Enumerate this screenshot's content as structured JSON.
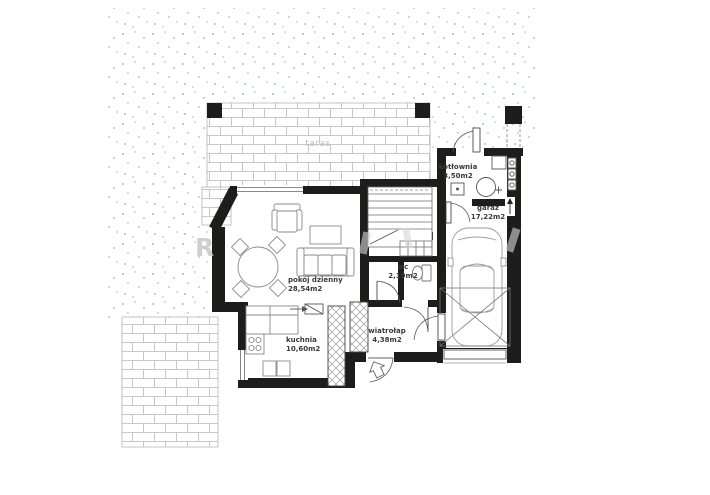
{
  "plan": {
    "rooms": [
      {
        "id": "pokoj-dzienny",
        "label": "pokój dzienny",
        "area": "28,54m2"
      },
      {
        "id": "kuchnia",
        "label": "kuchnia",
        "area": "10,60m2"
      },
      {
        "id": "wc",
        "label": "wc",
        "area": "2,19m2"
      },
      {
        "id": "wiatrolap",
        "label": "wiatrołap",
        "area": "4,38m2"
      },
      {
        "id": "kotlownia",
        "label": "kotłownia",
        "area": "3,50m2"
      },
      {
        "id": "garaz",
        "label": "garaż",
        "area": "17,22m2"
      }
    ],
    "outdoor_labels": {
      "terrace": "taras"
    },
    "watermark_letter": "R",
    "colors": {
      "wall": "#1d1d1b",
      "brick_line": "#c8c8c8",
      "ground_dots": "#7fa39e",
      "furniture_line": "#8a8a8a",
      "label_text": "#3a3a3a",
      "terrace_text": "#bdbdbd"
    }
  }
}
